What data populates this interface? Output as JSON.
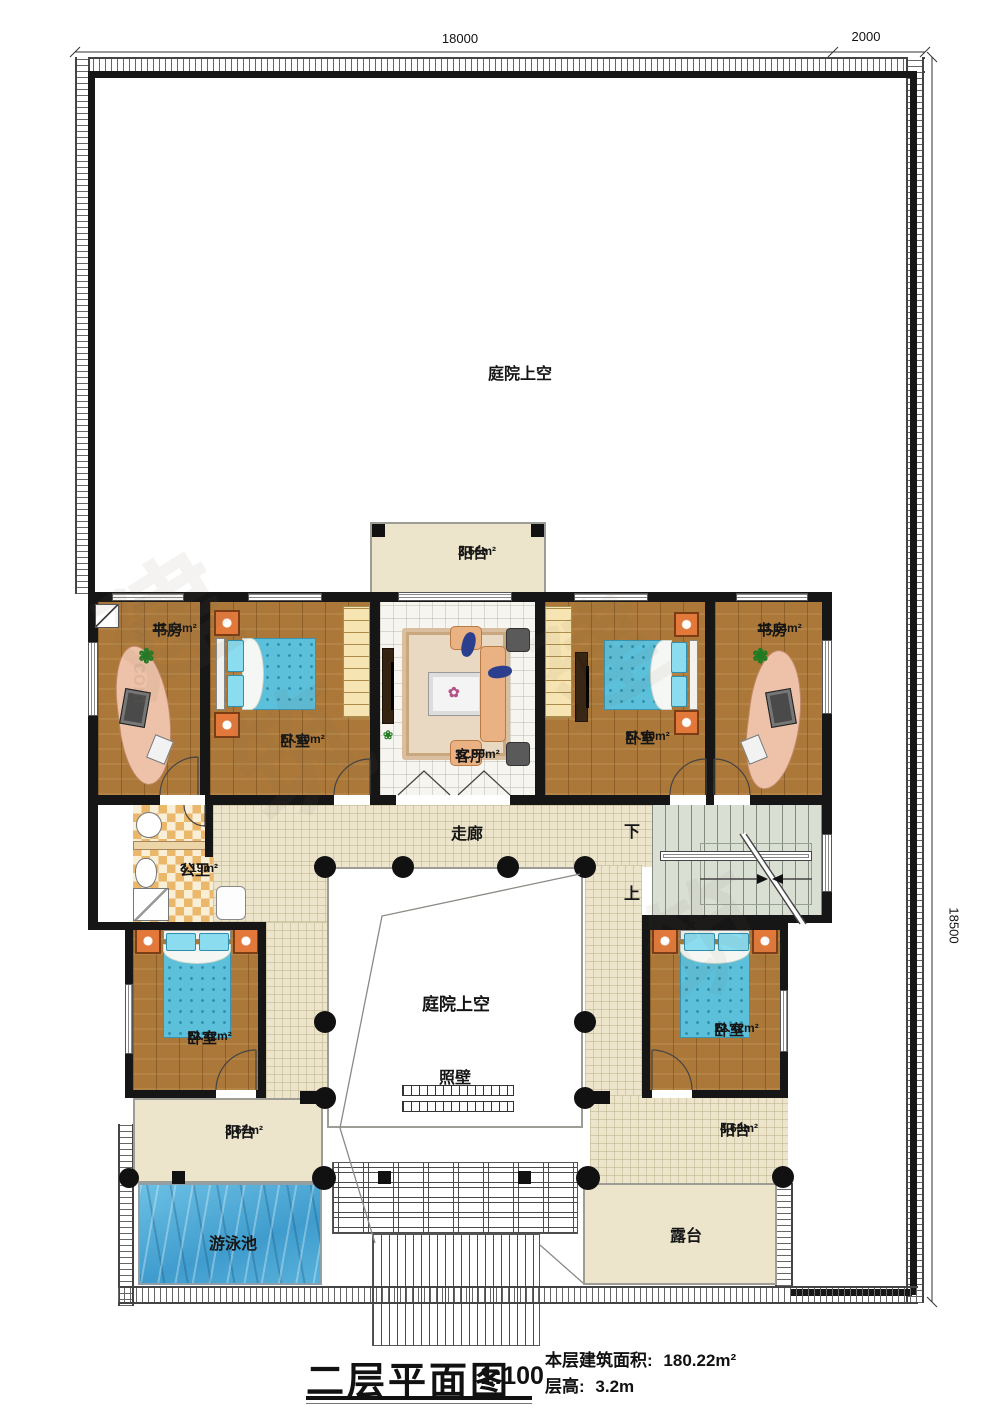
{
  "dimensions": {
    "top": "18000",
    "top_right": "2000",
    "right": "18500"
  },
  "title": {
    "name": "二层平面图",
    "scale": "1:100",
    "area_label": "本层建筑面积:",
    "area_value": "180.22m²",
    "floor_height_label": "层高:",
    "floor_height_value": "3.2m"
  },
  "labels": {
    "courtyard_top": "庭院上空",
    "courtyard_inner": "庭院上空",
    "screen_wall": "照壁",
    "corridor": "走廊",
    "down": "下",
    "up": "上",
    "pool": "游泳池",
    "terrace": "露台"
  },
  "rooms": [
    {
      "name": "书房",
      "area": "13.14m²"
    },
    {
      "name": "卧室",
      "area": "17.90m²"
    },
    {
      "name": "客厅",
      "area": "17.90m²"
    },
    {
      "name": "卧室",
      "area": "17.90m²"
    },
    {
      "name": "书房",
      "area": "13.14m²"
    },
    {
      "name": "公卫",
      "area": "3.19m²"
    },
    {
      "name": "卧室",
      "area": "12.42m²"
    },
    {
      "name": "卧室",
      "area": "12.42m²"
    },
    {
      "name": "阳台",
      "area": "2.56m²"
    },
    {
      "name": "阳台",
      "area": "3.67m²"
    },
    {
      "name": "阳台",
      "area": "4.63m²"
    }
  ],
  "watermark": {
    "char_a": "建",
    "char_b": "筑",
    "url": "www···com"
  }
}
